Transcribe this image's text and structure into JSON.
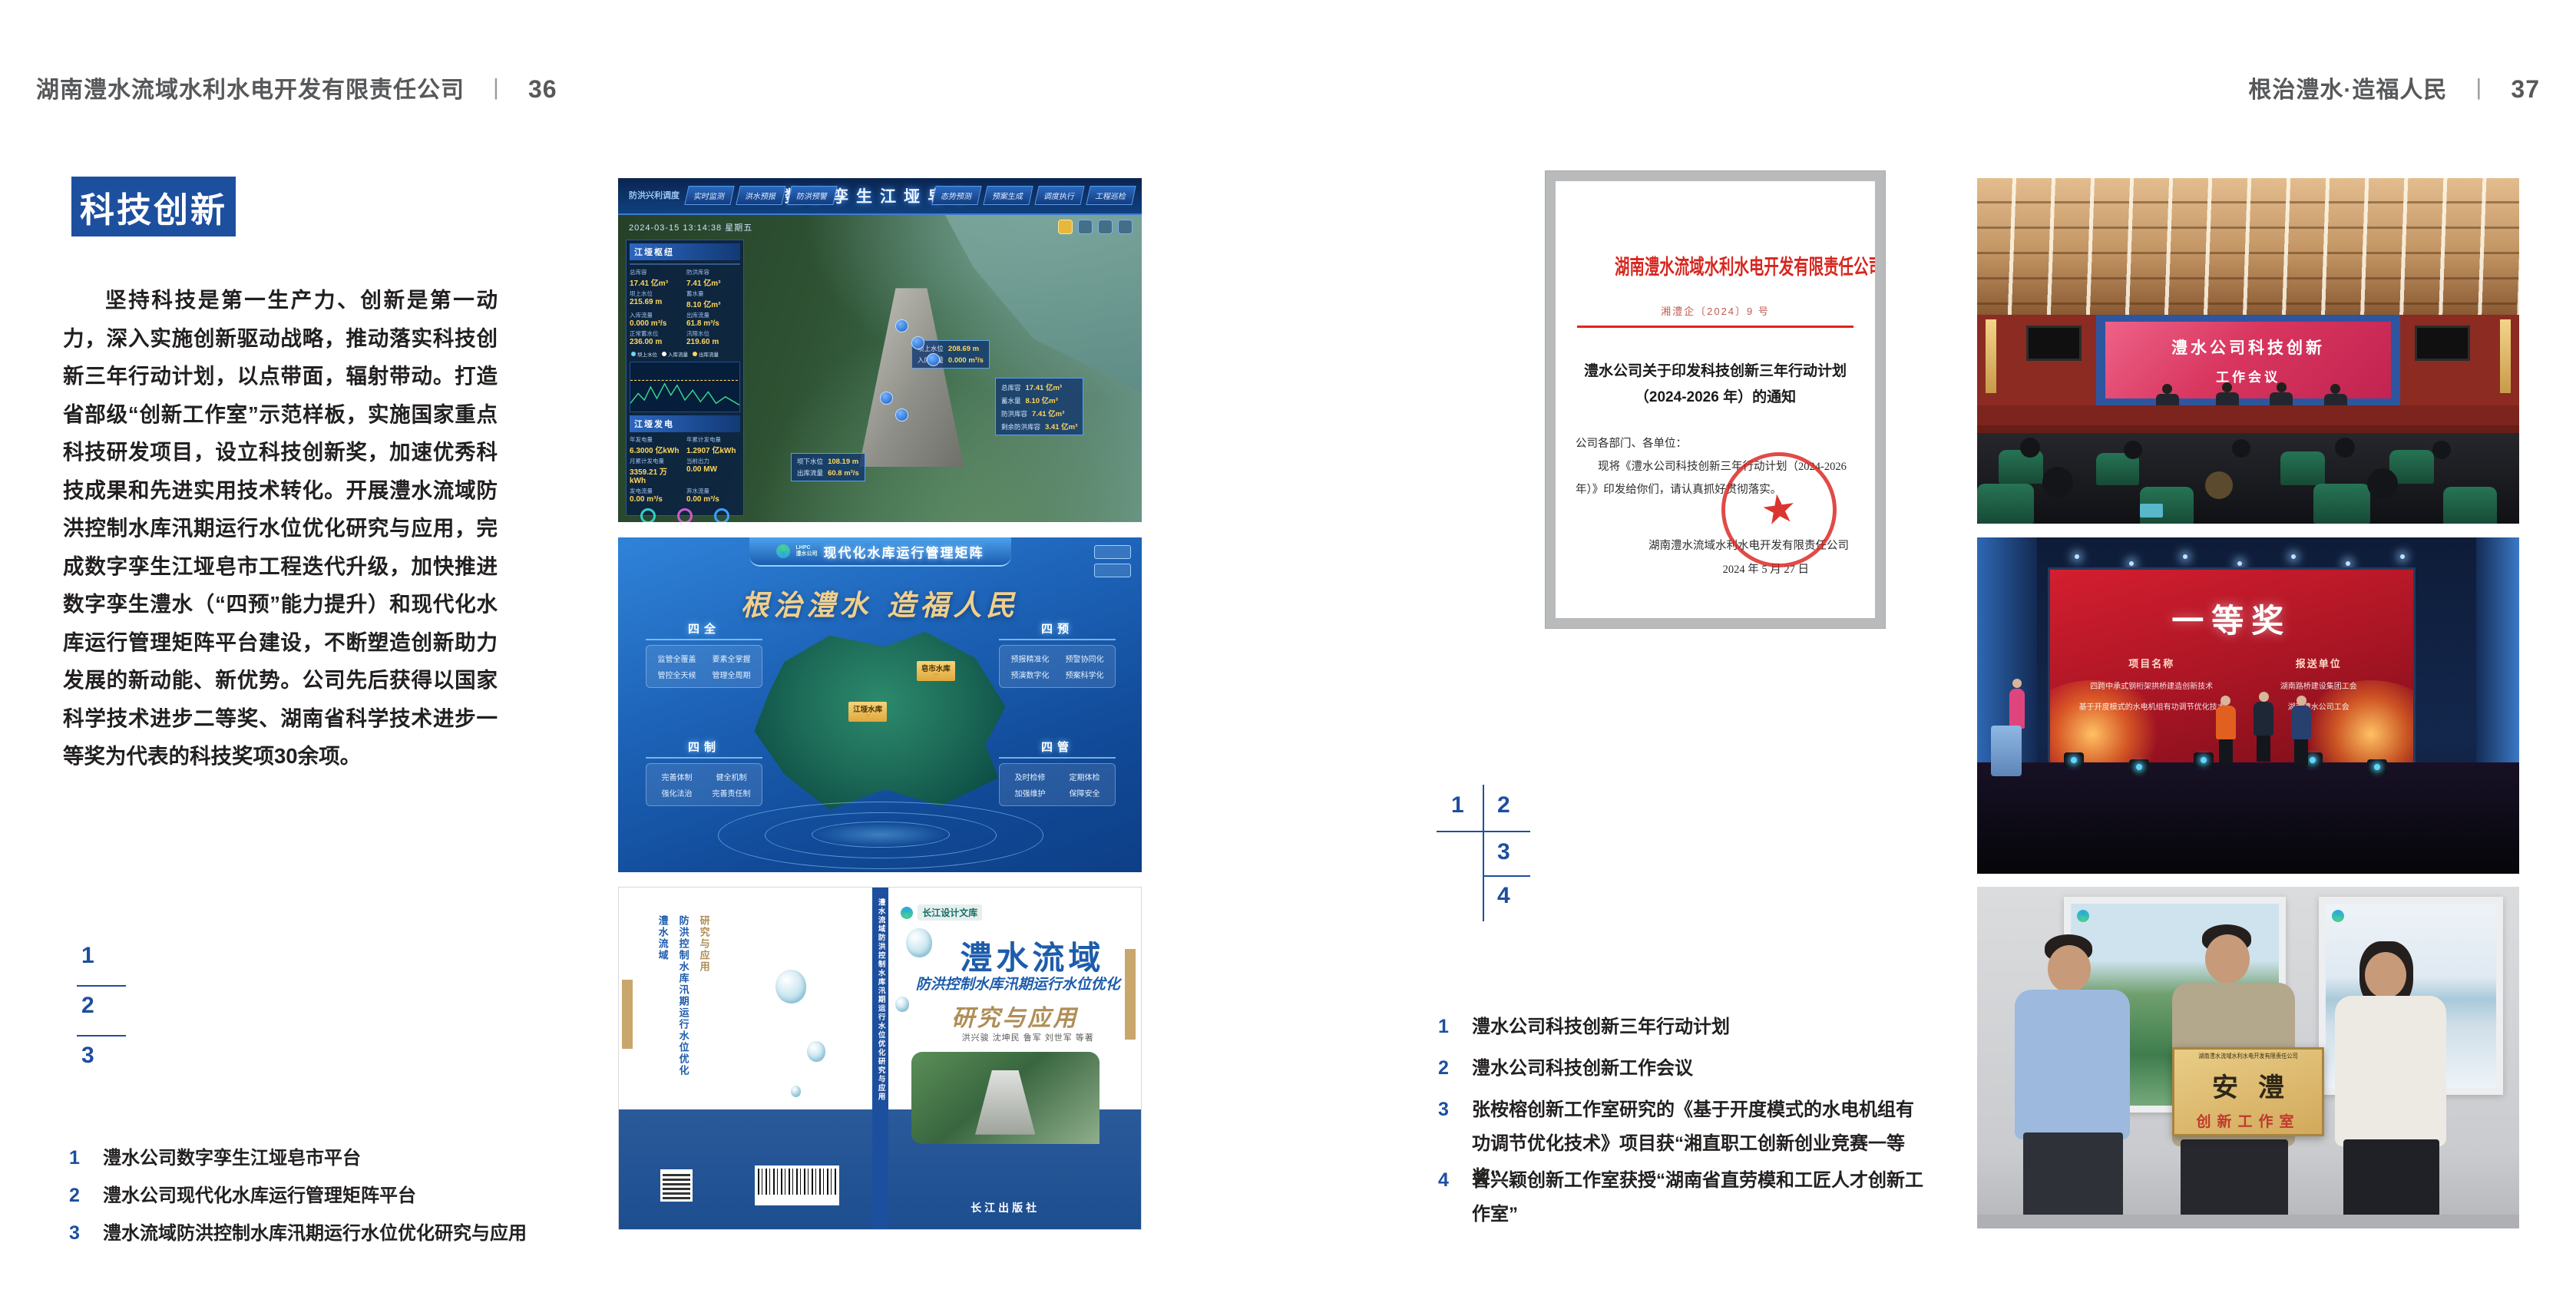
{
  "colors": {
    "accent_blue": "#1d4f9f",
    "doc_red": "#d7261e"
  },
  "page_left": {
    "header": {
      "company": "湖南澧水流域水利水电开发有限责任公司",
      "separator": "丨",
      "page_no": "36"
    },
    "badge": "科技创新",
    "paragraph": "坚持科技是第一生产力、创新是第一动力，深入实施创新驱动战略，推动落实科技创新三年行动计划，以点带面，辐射带动。打造省部级“创新工作室”示范样板，实施国家重点科技研发项目，设立科技创新奖，加速优秀科技成果和先进实用技术转化。开展澧水流域防洪控制水库汛期运行水位优化研究与应用，完成数字孪生江垭皂市工程迭代升级，加快推进数字孪生澧水（“四预”能力提升）和现代化水库运行管理矩阵平台建设，不断塑造创新助力发展的新动能、新优势。公司先后获得以国家科学技术进步二等奖、湖南省科学技术进步一等奖为代表的科技奖项30余项。",
    "figure_index": {
      "n1": "1",
      "n2": "2",
      "n3": "3"
    },
    "captions": [
      {
        "num": "1",
        "text": "澧水公司数字孪生江垭皂市平台"
      },
      {
        "num": "2",
        "text": "澧水公司现代化水库运行管理矩阵平台"
      },
      {
        "num": "3",
        "text": "澧水流域防洪控制水库汛期运行水位优化研究与应用"
      }
    ]
  },
  "page_right": {
    "header": {
      "slogan": "根治澧水·造福人民",
      "separator": "丨",
      "page_no": "37"
    },
    "figure_index": {
      "n1": "1",
      "n2": "2",
      "n3": "3",
      "n4": "4"
    },
    "captions": [
      {
        "num": "1",
        "text": "澧水公司科技创新三年行动计划"
      },
      {
        "num": "2",
        "text": "澧水公司科技创新工作会议"
      },
      {
        "num": "3",
        "text": "张桉榕创新工作室研究的《基于开度模式的水电机组有功调节优化技术》项目获“湘直职工创新创业竞赛一等奖”"
      },
      {
        "num": "4",
        "text": "曾兴颖创新工作室获授“湖南省直劳模和工匠人才创新工作室”"
      }
    ]
  },
  "fig_digital_twin": {
    "title": "数字孪生江垭皂市",
    "module_label": "防洪兴利调度",
    "tabs_left": [
      "实时监测",
      "洪水预报",
      "防洪预警"
    ],
    "tabs_right": [
      "态势预测",
      "预案生成",
      "调度执行",
      "工程巡检"
    ],
    "datetime": "2024-03-15 13:14:38 星期五",
    "panel1_title": "江垭枢纽",
    "stats": [
      {
        "label": "总库容",
        "value": "17.41 亿m³"
      },
      {
        "label": "防洪库容",
        "value": "7.41 亿m³"
      },
      {
        "label": "坝上水位",
        "value": "215.69 m"
      },
      {
        "label": "蓄水量",
        "value": "8.10 亿m³"
      },
      {
        "label": "入库流量",
        "value": "0.000 m³/s"
      },
      {
        "label": "出库流量",
        "value": "61.8 m³/s"
      },
      {
        "label": "正常蓄水位",
        "value": "236.00 m"
      },
      {
        "label": "汛限水位",
        "value": "219.60 m"
      }
    ],
    "legend": [
      "坝上水位",
      "入库流量",
      "出库流量"
    ],
    "panel2_title": "江垭发电",
    "stats2": [
      {
        "label": "年发电量",
        "value": "6.3000 亿kWh"
      },
      {
        "label": "年累计发电量",
        "value": "1.2907 亿kWh"
      },
      {
        "label": "月累计发电量",
        "value": "3359.21 万kWh"
      },
      {
        "label": "当前出力",
        "value": "0.00 MW"
      },
      {
        "label": "发电流量",
        "value": "0.00 m³/s"
      },
      {
        "label": "弃水流量",
        "value": "0.00 m³/s"
      }
    ],
    "tip1": [
      {
        "label": "坝上水位",
        "value": "208.69 m"
      },
      {
        "label": "入库流量",
        "value": "0.000 m³/s"
      }
    ],
    "tipbox": [
      {
        "label": "总库容",
        "value": "17.41 亿m³"
      },
      {
        "label": "蓄水量",
        "value": "8.10 亿m³"
      },
      {
        "label": "防洪库容",
        "value": "7.41 亿m³"
      },
      {
        "label": "剩余防洪库容",
        "value": "3.41 亿m³"
      }
    ],
    "tip2": [
      {
        "label": "坝下水位",
        "value": "108.19 m"
      },
      {
        "label": "出库流量",
        "value": "60.8 m³/s"
      }
    ]
  },
  "fig_matrix": {
    "brand_line1": "LHPC",
    "brand_line2": "澧水公司",
    "title": "现代化水库运行管理矩阵",
    "slogan": "根治澧水 造福人民",
    "map_labels": [
      "皂市水库",
      "江垭水库"
    ],
    "modules": [
      {
        "name": "四全",
        "items": [
          "监管全覆盖",
          "要素全掌握",
          "管控全天候",
          "管理全周期"
        ]
      },
      {
        "name": "四预",
        "items": [
          "预报精准化",
          "预警协同化",
          "预演数字化",
          "预案科学化"
        ]
      },
      {
        "name": "四制",
        "items": [
          "完善体制",
          "健全机制",
          "强化法治",
          "完善责任制"
        ]
      },
      {
        "name": "四管",
        "items": [
          "及时检修",
          "定期体检",
          "加强维护",
          "保障安全"
        ]
      }
    ]
  },
  "fig_book": {
    "series": "长江设计文库",
    "title": "澧水流域",
    "subtitle": "防洪控制水库汛期运行水位优化",
    "subtitle2": "研究与应用",
    "authors": "洪兴骏 沈坤民 鲁军 刘世军 等著",
    "publisher": "长江出版社",
    "spine_title": "澧水流域防洪控制水库汛期运行水位优化研究与应用",
    "back_title_1": "澧水流域",
    "back_title_2": "防洪控制水库汛期运行水位优化",
    "back_title_3": "研究与应用"
  },
  "fig_document": {
    "header": "湖南澧水流域水利水电开发有限责任公司文件",
    "doc_no": "湘澧企〔2024〕9 号",
    "title_line1": "澧水公司关于印发科技创新三年行动计划",
    "title_line2": "（2024-2026 年）的通知",
    "salutation": "公司各部门、各单位：",
    "body": "现将《澧水公司科技创新三年行动计划（2024-2026 年）》印发给你们，请认真抓好贯彻落实。",
    "signer": "湖南澧水流域水利水电开发有限责任公司",
    "date": "2024 年 5 月 27 日",
    "seal_star": "★"
  },
  "fig_meeting": {
    "screen_line1": "澧水公司科技创新",
    "screen_line2": "工作会议"
  },
  "fig_award": {
    "award_title": "一等奖",
    "col1_header": "项目名称",
    "col2_header": "报送单位",
    "col1_lines": [
      "四跨中承式钢桁架拱桥建造创新技术",
      "基于开度模式的水电机组有功调节优化技术"
    ],
    "col2_lines": [
      "湖南路桥建设集团工会",
      "湖南澧水公司工会"
    ]
  },
  "fig_plaque": {
    "org_line": "湖南澧水流域水利水电开发有限责任公司",
    "plaque_title": "安澧",
    "plaque_subtitle": "创新工作室"
  }
}
